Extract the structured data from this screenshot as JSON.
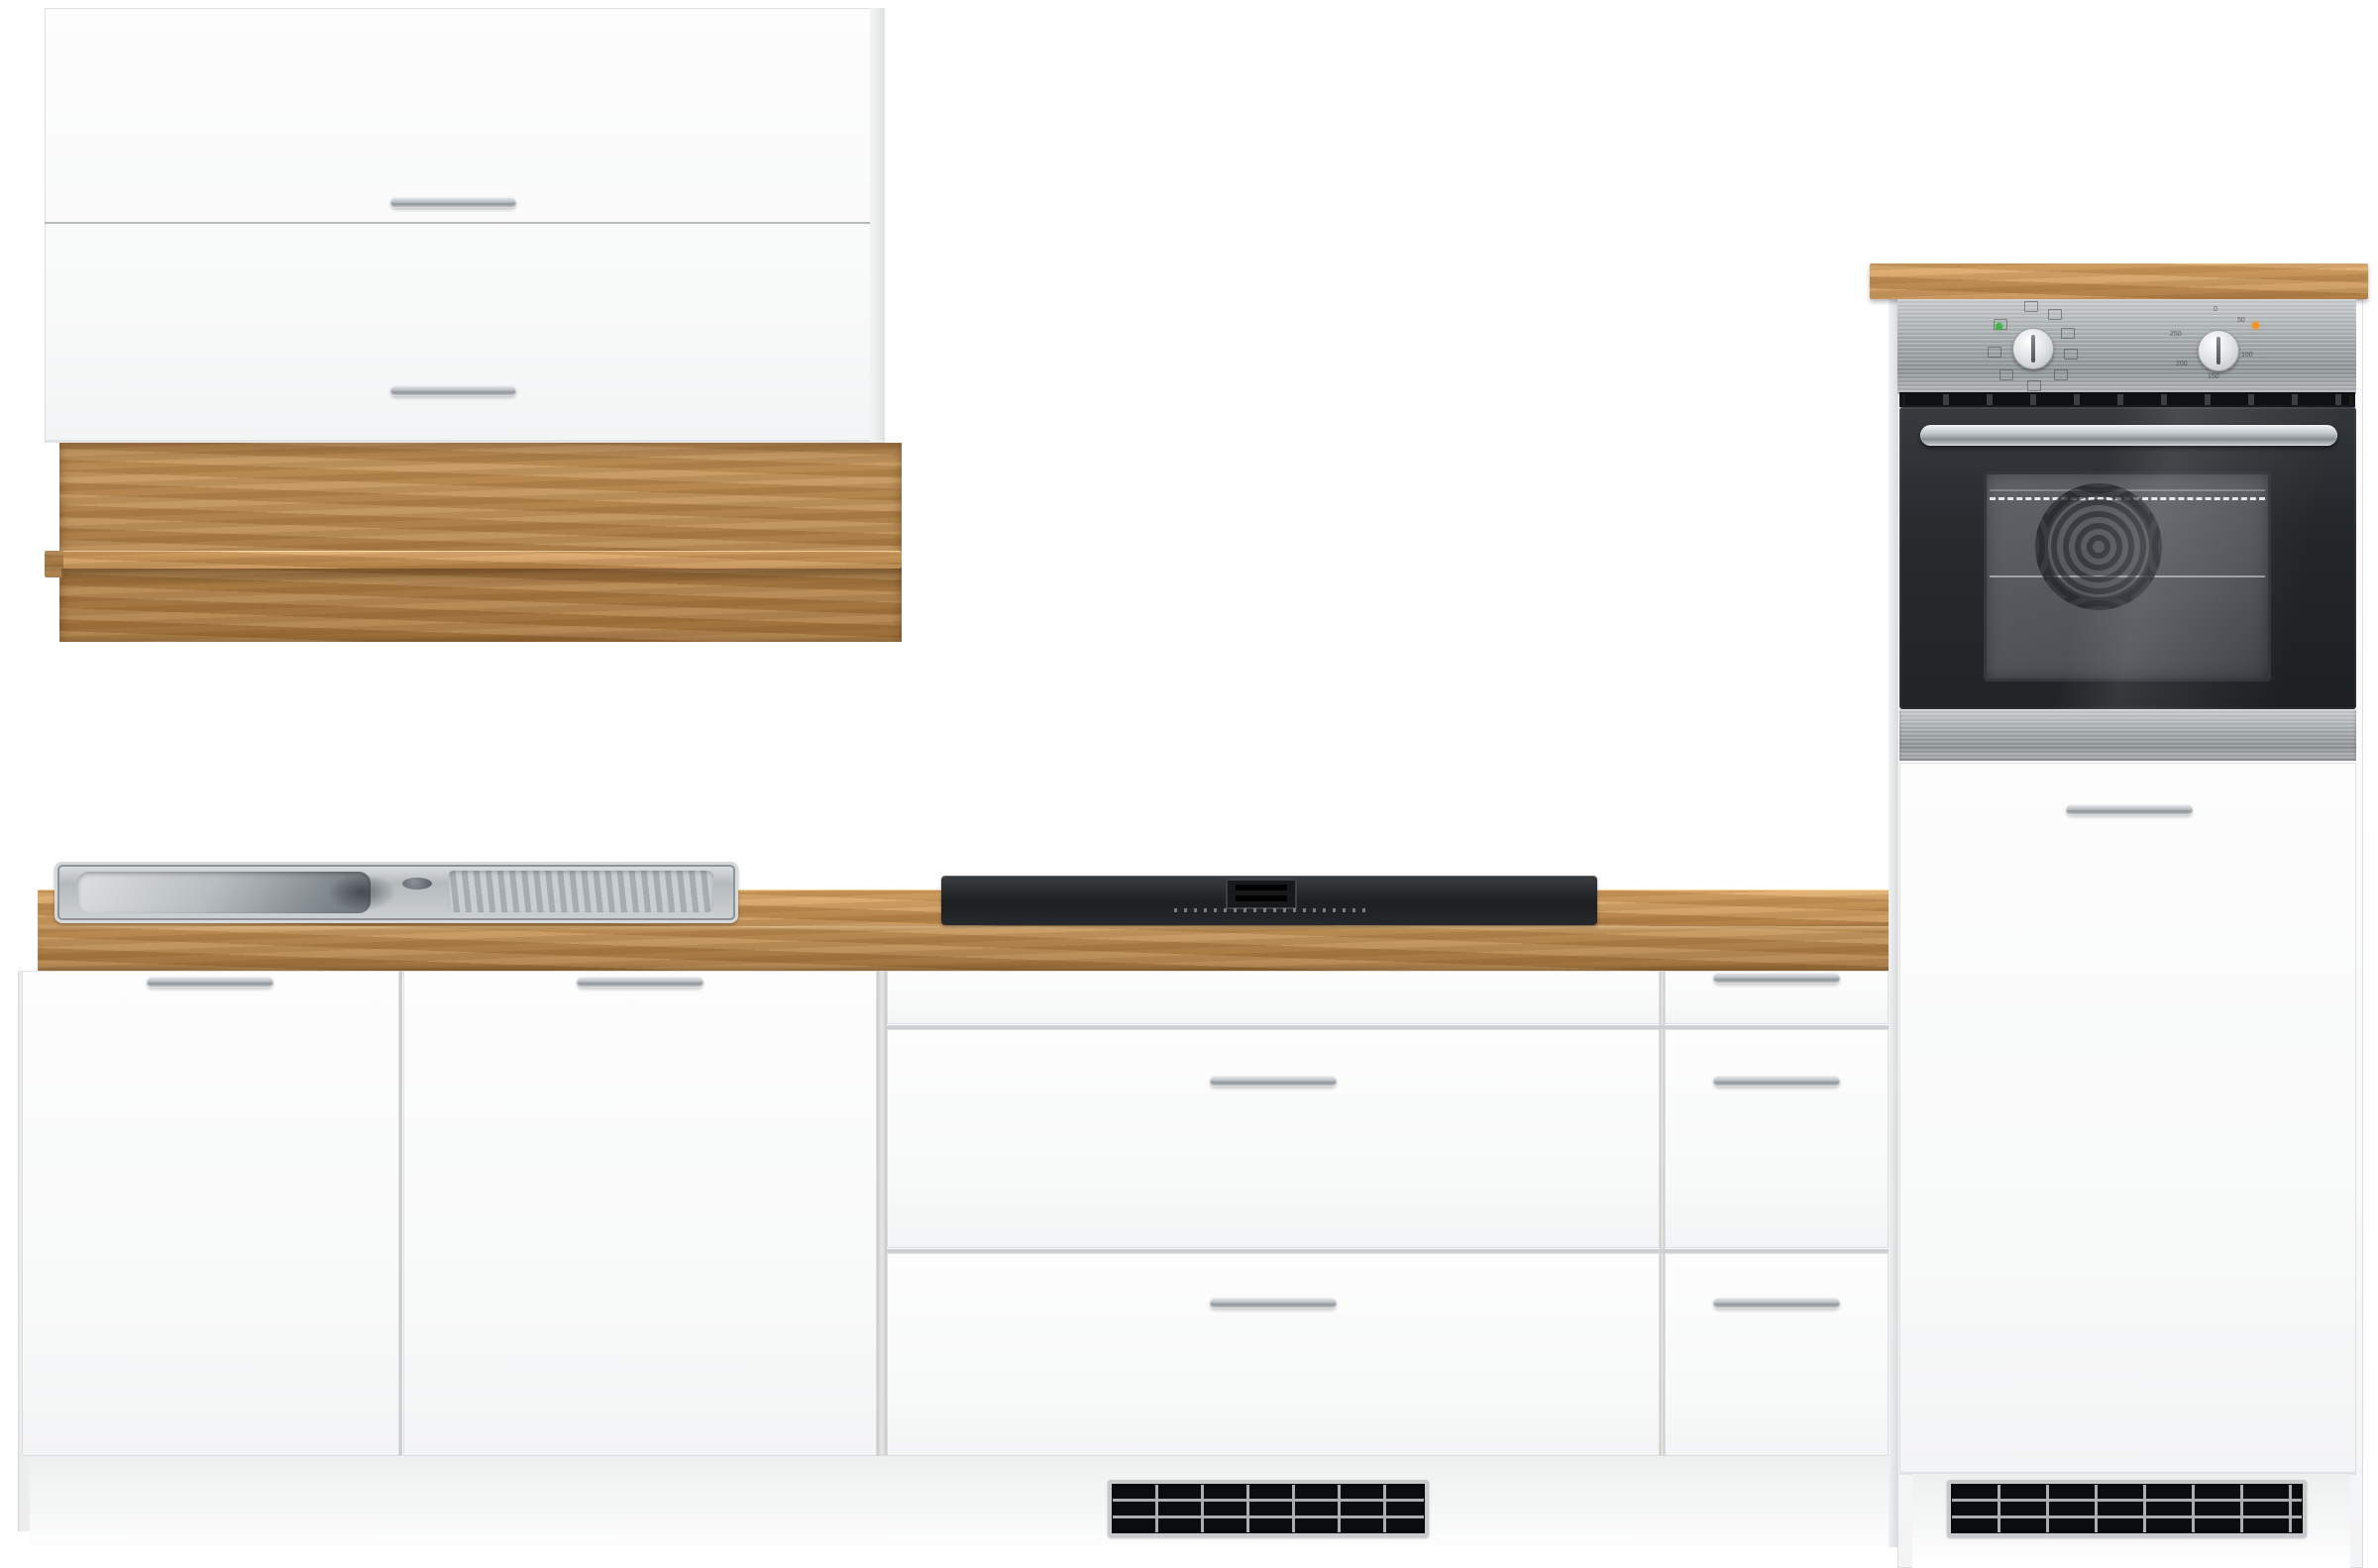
{
  "scene": {
    "type": "kitchen furniture product photo",
    "description": "White kitchen cabinet set with oak-effect accents: wall flap cabinet with oak shelf board, base run with stainless sink, black cooktop with integrated vent, drawer cabinets, and tall oven housing with built-in stainless/black oven",
    "background_color": "#ffffff"
  },
  "palette": {
    "front_white": "#fbfbfc",
    "edge_line": "#cdd0d2",
    "handle_silver": "#c0c5c8",
    "wood_mid": "#b1824a",
    "wood_light": "#c49459",
    "wood_dark": "#a5753f",
    "steel_light": "#c9cdcf",
    "steel_dark": "#8f9497",
    "oven_glass": "#26292c",
    "oven_cavity": "#55595d",
    "grille_black": "#0b0c0d",
    "grille_frame": "#c6cacc",
    "led_green": "#43b649",
    "led_orange": "#f7941d",
    "plinth": "#f4f5f6"
  },
  "wall_cabinet": {
    "name": "wall cabinet with two lift flaps",
    "doors": [
      {
        "id": "top-flap",
        "handle": "silver bar"
      },
      {
        "id": "bottom-flap",
        "handle": "silver bar"
      }
    ]
  },
  "wall_shelf": {
    "name": "oak wall board with shelf rail"
  },
  "base_run": {
    "countertop": "oak worktop",
    "sink": {
      "type": "stainless steel inset sink",
      "bowl_side": "left",
      "drainer_side": "right",
      "faucet_hole": 1
    },
    "cooktop": {
      "type": "black glass hob with integrated center vent"
    },
    "sections": [
      {
        "id": "sink-cabinet",
        "fronts": [
          "door",
          "door"
        ]
      },
      {
        "id": "drawer-cabinet-wide",
        "fronts": [
          "fixed-panel",
          "drawer",
          "drawer"
        ]
      },
      {
        "id": "drawer-cabinet-narrow",
        "fronts": [
          "drawer",
          "drawer",
          "drawer"
        ]
      }
    ],
    "vent_grille": {
      "rows": 3,
      "cols": 7
    }
  },
  "tall_unit": {
    "name": "oven housing tall cabinet",
    "top": "oak board",
    "oven": {
      "type": "built-in oven, stainless control panel with black glass door",
      "function_knob": {
        "icon_count": 9
      },
      "temp_knob": {
        "labels": [
          "0",
          "50",
          "100",
          "150",
          "200",
          "250"
        ]
      },
      "leds": {
        "power": "#43b649",
        "heat": "#f7941d"
      }
    },
    "door": {
      "id": "lower-door",
      "handle": "silver bar"
    },
    "vent_grille": {
      "rows": 3,
      "cols": 7
    }
  }
}
